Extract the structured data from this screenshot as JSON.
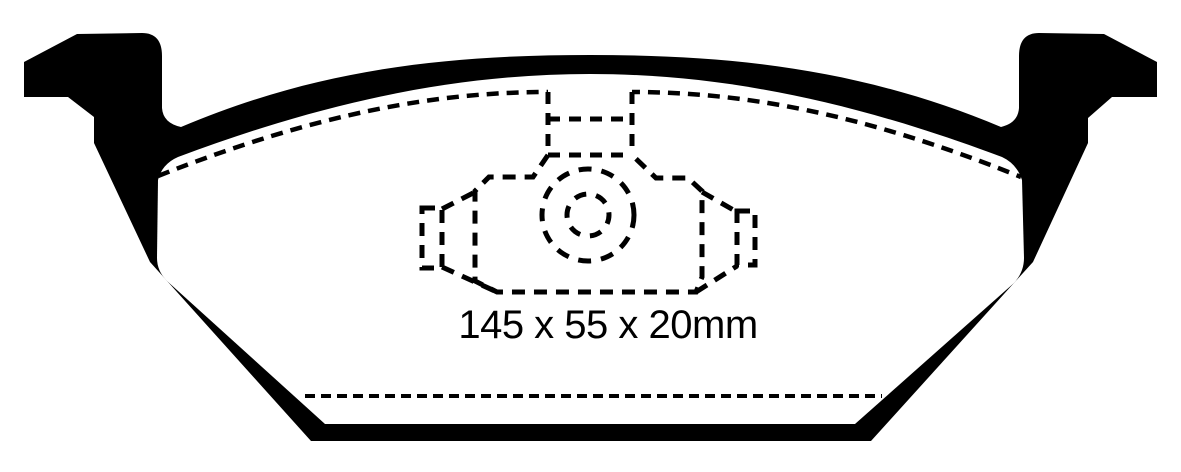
{
  "diagram": {
    "figure": "brake-pad-outline-drawing",
    "dimension_label": "145 x 55 x 20mm",
    "dimensions": {
      "length": "145",
      "width": "55",
      "thickness": "20",
      "unit": "mm"
    },
    "colors": {
      "line": "#000000",
      "background": "#ffffff"
    }
  }
}
